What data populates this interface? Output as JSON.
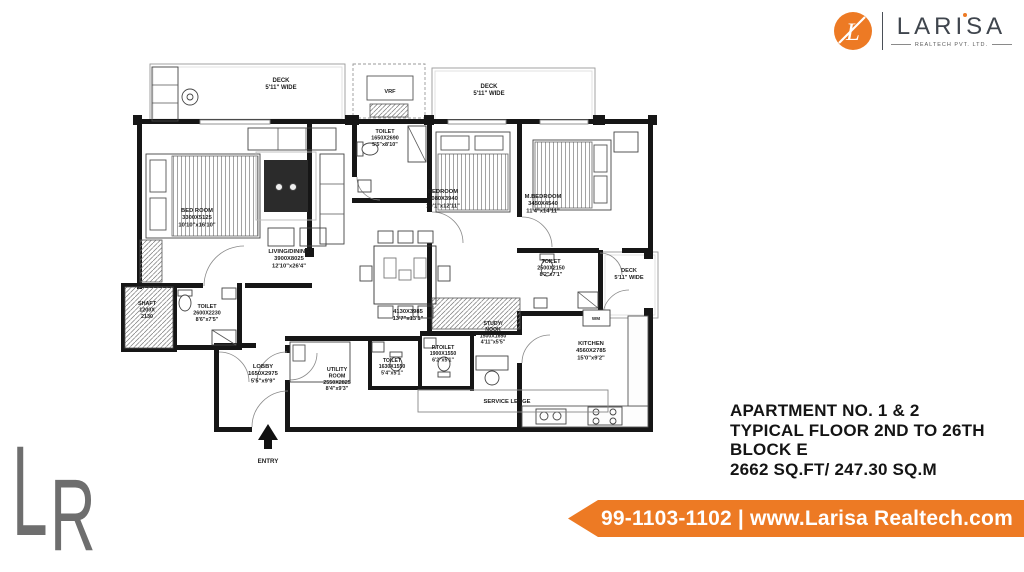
{
  "colors": {
    "orange": "#ED7A24",
    "ink": "#141414",
    "watermark_gray": "#6E6E6E",
    "plan_line": "#1a1a1a"
  },
  "logo": {
    "monogram": "L",
    "brand": "LARISA",
    "tagline": "REALTECH PVT. LTD."
  },
  "watermark": {
    "letter_l": "L",
    "letter_r": "R"
  },
  "info": {
    "lines": [
      "APARTMENT NO. 1 & 2",
      "TYPICAL FLOOR 2ND TO 26TH",
      "BLOCK E",
      "2662 SQ.FT/ 247.30 SQ.M"
    ]
  },
  "banner": {
    "text": "99-1103-1102 | www.Larisa Realtech.com"
  },
  "floorplan": {
    "rooms": [
      {
        "id": "deck-top-left",
        "lines": [
          "DECK",
          "5'11\" WIDE"
        ]
      },
      {
        "id": "vrf",
        "lines": [
          "VRF"
        ]
      },
      {
        "id": "deck-top-right",
        "lines": [
          "DECK",
          "5'11\" WIDE"
        ]
      },
      {
        "id": "bed-room",
        "lines": [
          "BED ROOM",
          "3300X5125",
          "10'10\"x16'10\""
        ]
      },
      {
        "id": "toilet-1",
        "lines": [
          "TOILET",
          "1650X2690",
          "5'5\"x8'10\""
        ]
      },
      {
        "id": "living-dining",
        "lines": [
          "LIVING/DINING",
          "3900X8025",
          "12'10\"x26'4\""
        ]
      },
      {
        "id": "bedroom",
        "lines": [
          "BEDROOM",
          "3080X3940",
          "10'1\"x12'11\""
        ]
      },
      {
        "id": "m-bedroom",
        "lines": [
          "M.BEDROOM",
          "3450X4540",
          "11'4\"x14'11\""
        ]
      },
      {
        "id": "toilet-right",
        "lines": [
          "TOILET",
          "2500X2150",
          "8'2\"x7'1\""
        ]
      },
      {
        "id": "deck-right",
        "lines": [
          "DECK",
          "5'11\" WIDE"
        ]
      },
      {
        "id": "study-nook",
        "lines": [
          "STUDY/",
          "NOOK",
          "1500X1650",
          "4'11\"x5'5\""
        ]
      },
      {
        "id": "kitchen",
        "lines": [
          "KITCHEN",
          "4560X2785",
          "15'0\"x9'2\""
        ]
      },
      {
        "id": "dining-area",
        "lines": [
          "4130X3985",
          "13'7\"x13'1\""
        ]
      },
      {
        "id": "shaft",
        "lines": [
          "SHAFT",
          "1200X",
          "2130"
        ]
      },
      {
        "id": "toilet-left",
        "lines": [
          "TOILET",
          "2600X2230",
          "8'6\"x7'5\""
        ]
      },
      {
        "id": "lobby",
        "lines": [
          "LOBBY",
          "1650X2975",
          "5'5\"x9'9\""
        ]
      },
      {
        "id": "utility-room",
        "lines": [
          "UTILITY",
          "ROOM",
          "2550X2825",
          "8'4\"x9'3\""
        ]
      },
      {
        "id": "toilet-small",
        "lines": [
          "TOILET",
          "1630X1550",
          "5'4\"x5'1\""
        ]
      },
      {
        "id": "p-toilet",
        "lines": [
          "P.TOILET",
          "1900X1550",
          "6'2\"x5'1\""
        ]
      },
      {
        "id": "service-ledge",
        "lines": [
          "SERVICE LEDGE"
        ]
      },
      {
        "id": "entry",
        "lines": [
          "ENTRY"
        ]
      },
      {
        "id": "washing-machine",
        "lines": [
          "WM"
        ]
      }
    ]
  }
}
